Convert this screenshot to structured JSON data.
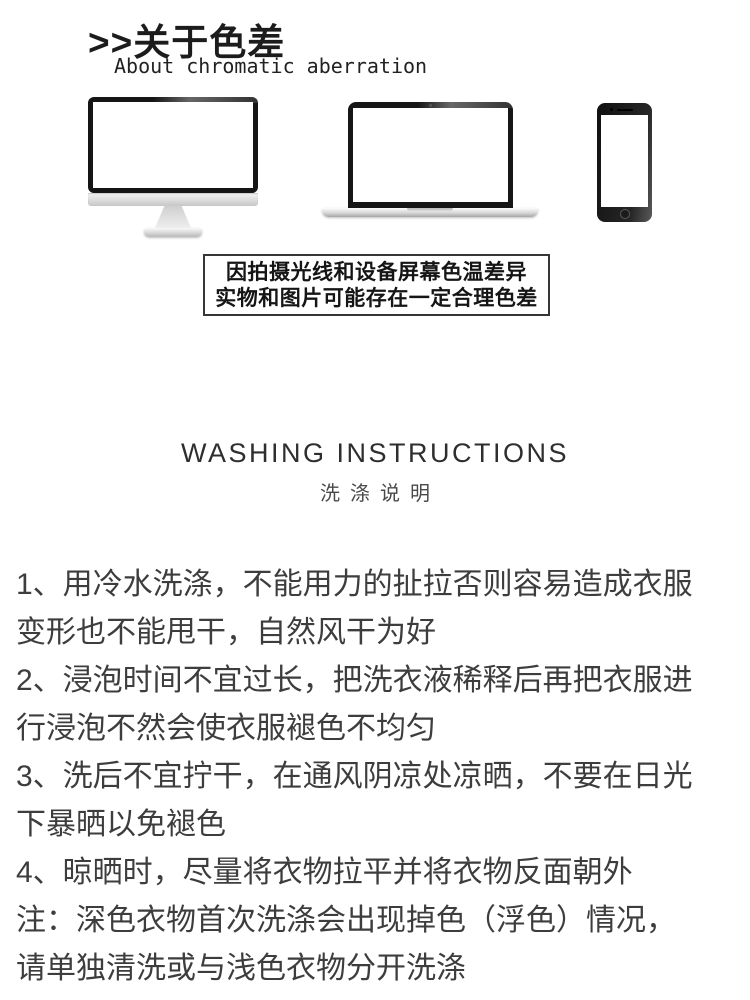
{
  "page": {
    "background": "#ffffff"
  },
  "chromatic_section": {
    "title": ">>关于色差",
    "subtitle": "About chromatic aberration",
    "devices": [
      {
        "icon": "desktop-monitor-icon"
      },
      {
        "icon": "laptop-icon"
      },
      {
        "icon": "smartphone-icon"
      }
    ],
    "notice_line1": "因拍摄光线和设备屏幕色温差异",
    "notice_line2": "实物和图片可能存在一定合理色差"
  },
  "washing_section": {
    "title": "WASHING INSTRUCTIONS",
    "subtitle": "洗涤说明",
    "instructions": [
      "1、用冷水洗涤，不能用力的扯拉否则容易造成衣服\n变形也不能甩干，自然风干为好",
      "2、浸泡时间不宜过长，把洗衣液稀释后再把衣服进\n行浸泡不然会使衣服褪色不均匀",
      "3、洗后不宜拧干，在通风阴凉处凉晒，不要在日光\n下暴晒以免褪色",
      "4、晾晒时，尽量将衣物拉平并将衣物反面朝外",
      "注：深色衣物首次洗涤会出现掉色（浮色）情况，\n请单独清洗或与浅色衣物分开洗涤"
    ]
  },
  "colors": {
    "heading": "#1c1c1c",
    "body_text": "#3d3d3d",
    "notice_border": "#363636",
    "washing_title": "#2e2e2e",
    "washing_subtitle": "#4a4a4a",
    "device_bezel": "#151515",
    "device_silver": "#c6c6c6"
  }
}
